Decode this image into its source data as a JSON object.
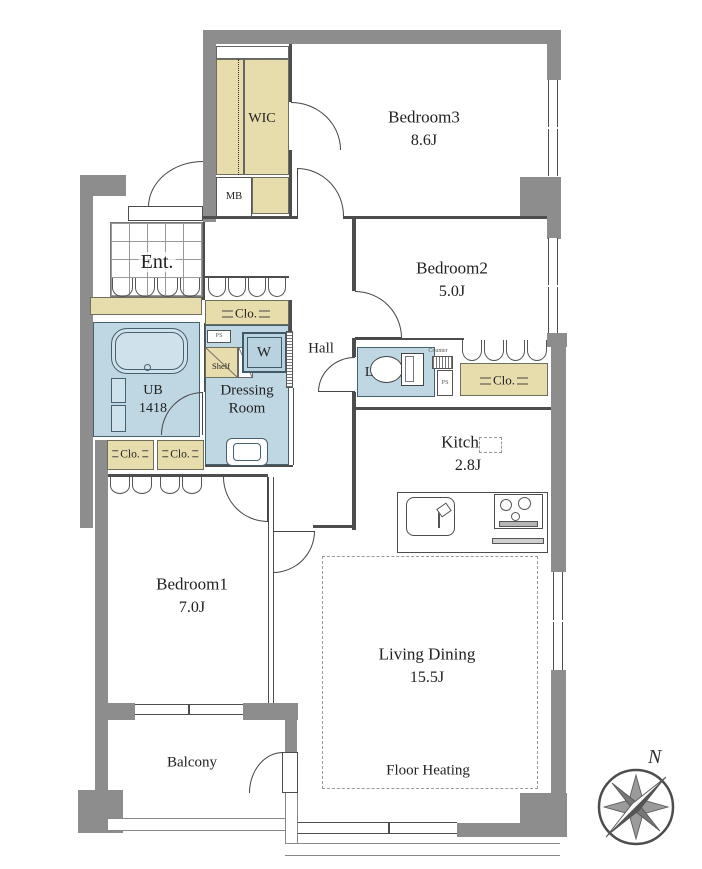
{
  "floor_plan": {
    "rooms": {
      "wic": {
        "label": "WIC"
      },
      "mb": {
        "label": "MB"
      },
      "bedroom3": {
        "name": "Bedroom3",
        "area": "8.6J"
      },
      "bedroom2": {
        "name": "Bedroom2",
        "area": "5.0J"
      },
      "entrance": {
        "label": "Ent."
      },
      "hall": {
        "label": "Hall"
      },
      "hall_closet": {
        "label": "Clo."
      },
      "bedroom2_closet": {
        "label": "Clo."
      },
      "bedroom1_closet_left": {
        "label": "Clo."
      },
      "bedroom1_closet_right": {
        "label": "Clo."
      },
      "unit_bath": {
        "line1": "UB",
        "line2": "1418"
      },
      "dressing_room": {
        "line1": "Dressing",
        "line2": "Room"
      },
      "shelf": {
        "label": "Shelf"
      },
      "washer": {
        "label": "W"
      },
      "pipe_space_dressing": {
        "label": "PS"
      },
      "pipe_space_lav": {
        "label": "PS"
      },
      "counter": {
        "label": "Counter"
      },
      "lavatory": {
        "label": "Lav."
      },
      "kitchen": {
        "name": "Kitchen",
        "area": "2.8J"
      },
      "living_dining": {
        "name": "Living Dining",
        "area": "15.5J"
      },
      "floor_heating": {
        "label": "Floor Heating"
      },
      "bedroom1": {
        "name": "Bedroom1",
        "area": "7.0J"
      },
      "balcony": {
        "label": "Balcony"
      }
    },
    "compass": {
      "north_label": "N"
    },
    "colors": {
      "wall": "#8d8d8d",
      "closet_fill": "#e7dcab",
      "wet_area_fill": "#bfd7e2",
      "line": "#4d4d4d",
      "background": "#ffffff"
    }
  }
}
